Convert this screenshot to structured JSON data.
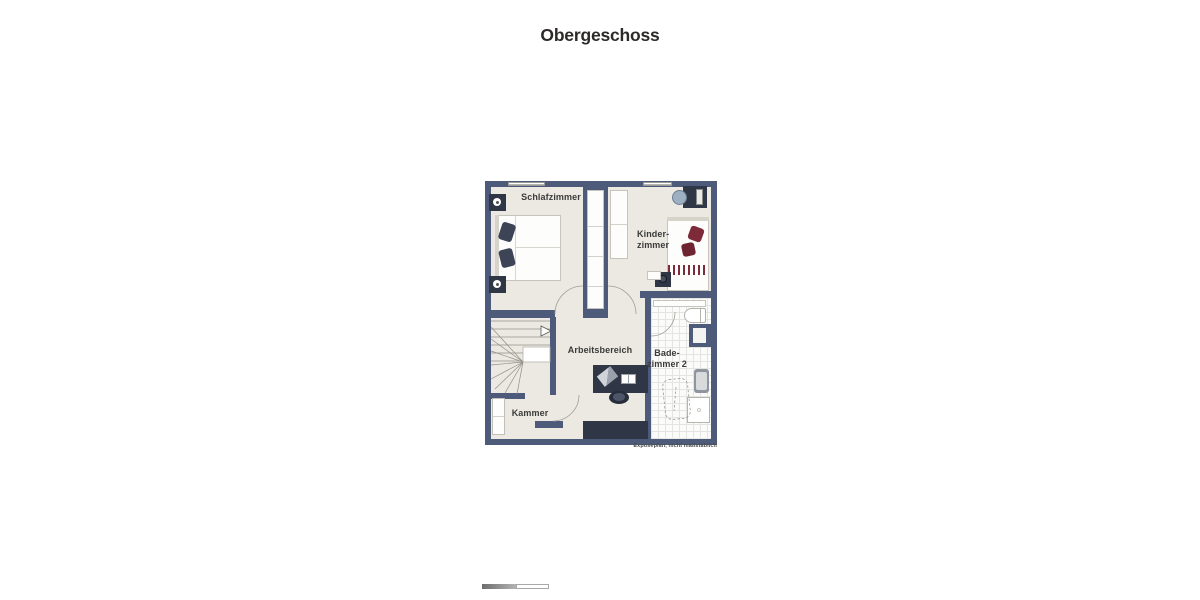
{
  "title": "Obergeschoss",
  "plan": {
    "caption": "Exposéplan, nicht maßstäblich",
    "watermark": "Illustration Immobilien",
    "rooms": {
      "schlafzimmer": "Schlafzimmer",
      "kinderzimmer": "Kinder-\nzimmer",
      "arbeitsbereich": "Arbeitsbereich",
      "badezimmer": "Bade-\nzimmer 2",
      "kammer": "Kammer"
    }
  },
  "colors": {
    "wall": "#4d5a7a",
    "floor": "#ece9e2",
    "furniture-dark": "#2f3747",
    "maroon": "#7d2b39",
    "pillow-slate": "#3d4456",
    "chair-blue": "#9db0c2",
    "tile-line": "#e4e4e0",
    "line-gray": "#a09e96",
    "title-color": "#2e2a2a"
  }
}
